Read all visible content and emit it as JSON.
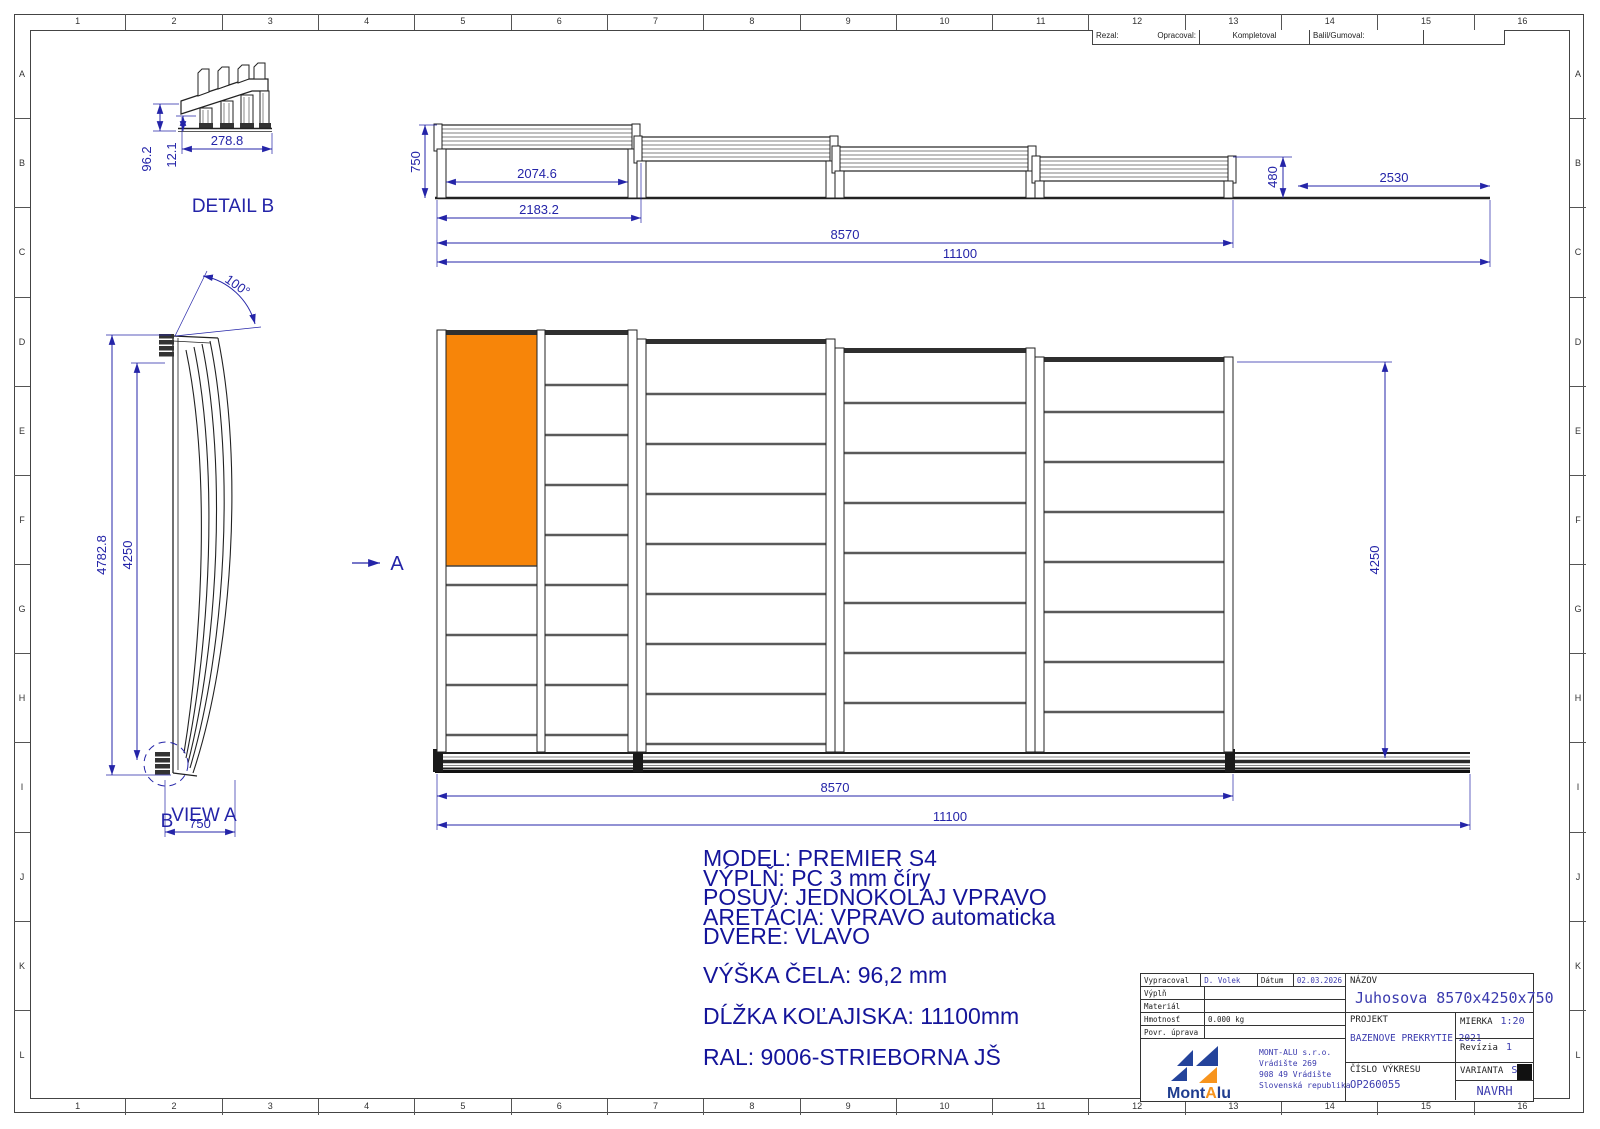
{
  "colors": {
    "dim": "#2424a8",
    "line": "#222222",
    "door_orange": "#f78509",
    "spec_blue": "#14149a",
    "value_blue": "#3a3aae",
    "logo_blue": "#24439b",
    "logo_orange": "#f7941d"
  },
  "grid": {
    "cols": [
      "1",
      "2",
      "3",
      "4",
      "5",
      "6",
      "7",
      "8",
      "9",
      "10",
      "11",
      "12",
      "13",
      "14",
      "15",
      "16"
    ],
    "rows": [
      "A",
      "B",
      "C",
      "D",
      "E",
      "F",
      "G",
      "H",
      "I",
      "J",
      "K",
      "L"
    ]
  },
  "process_strip": {
    "rezal": "Rezal:",
    "opracoval": "Opracoval:",
    "kompletoval": "Kompletoval",
    "balil": "Balil/Gumoval:"
  },
  "detail_b": {
    "label": "DETAIL B",
    "dim_width": "278.8",
    "dim_height": "96.2",
    "dim_offset": "12.1"
  },
  "side_view": {
    "dim_height": "750",
    "dim_inner": "2074.6",
    "dim_outer": "2183.2",
    "dim_body": "8570",
    "dim_total": "11100",
    "dim_end_height": "480",
    "dim_tail": "2530"
  },
  "view_a": {
    "label": "VIEW A",
    "detail_marker": "B",
    "dim_outer_height": "4782.8",
    "dim_inner_height": "4250",
    "dim_angle": "100°",
    "dim_width": "750"
  },
  "plan": {
    "section_label": "A",
    "dim_body": "8570",
    "dim_total": "11100",
    "dim_width": "4250"
  },
  "specs": {
    "model": "MODEL: PREMIER S4",
    "vypln": "VÝPLŇ: PC 3 mm číry",
    "posuv": "POSUV: JEDNOKOLAJ VPRAVO",
    "aretacia": "ARETÁCIA: VPRAVO automaticka",
    "dvere": "DVERE: VLAVO",
    "vyska": "VÝŠKA ČELA: 96,2 mm",
    "dlzka": "DĹŽKA KOĽAJISKA: 11100mm",
    "ral": "RAL: 9006-STRIEBORNA JŠ"
  },
  "title_block": {
    "vypracoval_label": "Vypracoval",
    "vypracoval_value": "D. Volek",
    "datum_label": "Dátum",
    "datum_value": "02.03.2026",
    "vypln_label": "Výplň",
    "material_label": "Materiál",
    "hmotnost_label": "Hmotnosť",
    "hmotnost_value": "0.000 kg",
    "povrch_label": "Povr. úprava",
    "logo_part1": "Mont",
    "logo_part2": "A",
    "logo_part3": "lu",
    "company_name": "MONT-ALU  s.r.o.",
    "address1": "Vrádište 269",
    "address2": "908 49 Vrádište",
    "address3": "Slovenská republika",
    "nazov_label": "NÁZOV",
    "nazov_value": "Juhosova 8570x4250x750",
    "projekt_label": "PROJEKT",
    "projekt_value": "BAZENOVE PREKRYTIE 2021",
    "mierka_label": "MIERKA",
    "mierka_value": "1:20",
    "revizia_label": "Revízia",
    "revizia_value": "1",
    "cislo_label": "ČÍSLO VÝKRESU",
    "cislo_value": "OP260055",
    "varianta_label": "VARIANTA",
    "varianta_value": "S4",
    "navrh": "NAVRH"
  }
}
